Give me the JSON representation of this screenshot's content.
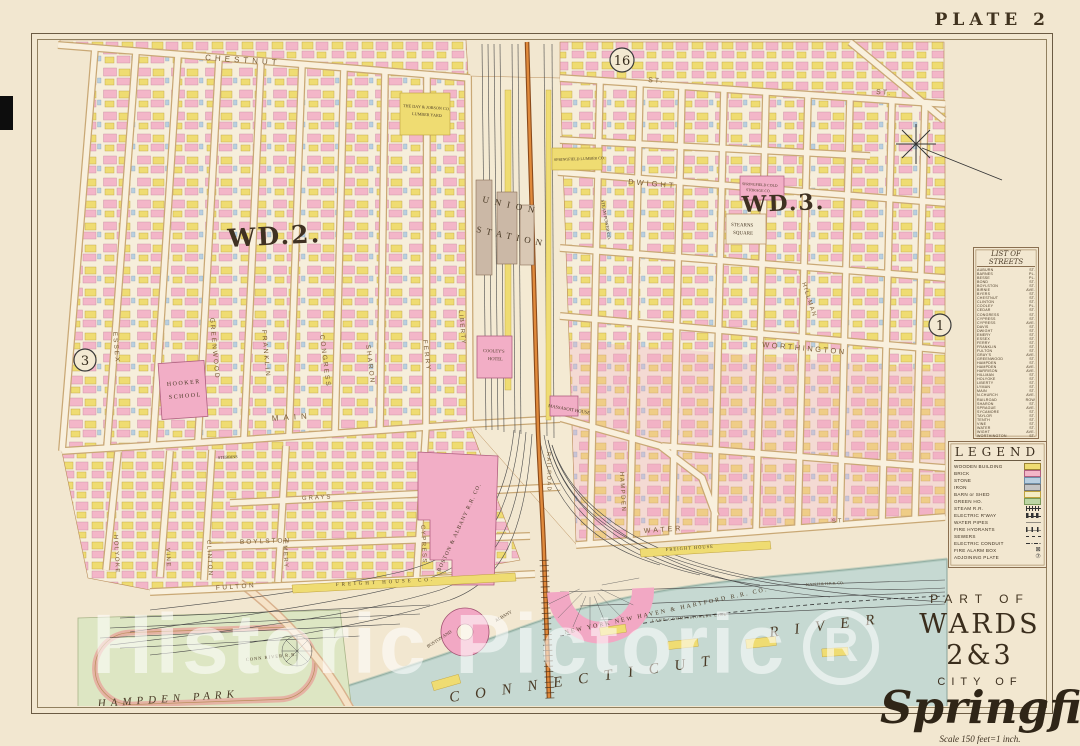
{
  "plate_label": "PLATE 2",
  "adjoining": {
    "top": "16",
    "left": "3",
    "right": "1"
  },
  "wards": {
    "wd2": "WD.2.",
    "wd3": "WD.3."
  },
  "street_labels": {
    "chestnut": "CHESTNUT",
    "st_a": "ST.",
    "st_b": "ST.",
    "dwight": "DWIGHT",
    "worthington": "WORTHINGTON",
    "main": "MAIN",
    "grays": "GRAYS",
    "boylston": "BOYLSTON",
    "fulton": "FULTON",
    "water": "WATER",
    "water_st": "ST.",
    "essex": "ESSEX",
    "greenwood": "GREENWOOD",
    "franklin": "FRANKLIN",
    "congress": "CONGRESS",
    "sharon": "SHARON",
    "ferry": "FERRY",
    "vine": "VINE",
    "clinton": "CLINTON",
    "holyoke": "HOLYOKE",
    "emery": "EMERY",
    "cypress": "CYPRESS",
    "liberty": "LIBERTY",
    "hampden": "HAMPDEN",
    "railroad": "RAILROAD",
    "hillman": "HILLMAN"
  },
  "features": {
    "union_1": "UNION",
    "union_2": "STATION",
    "massasoit": "MASSASOIT HOUSE",
    "cooleys_1": "COOLEY'S",
    "cooleys_2": "HOTEL",
    "hooker_1": "HOOKER",
    "hooker_2": "SCHOOL",
    "stearns_1": "STEARNS",
    "stearns_2": "SQUARE",
    "day_jobson_1": "THE DAY & JOBSON CO.",
    "day_jobson_2": "LUMBER YARD",
    "cold_storage_1": "SPRINGFIELD COLD",
    "cold_storage_2": "STORAGE CO.",
    "lumber": "SPRINGFIELD LUMBER CO.",
    "steam_power": "STEAM POWER CO.",
    "boston_albany_rr": "BOSTON & ALBANY R.R. CO.",
    "freight_house_1": "FREIGHT HOUSE CO.",
    "freight_house_2": "FREIGHT HOUSE",
    "nynh_rr": "NEW YORK NEW HAVEN & HARTFORD R.R. CO.",
    "nynh_small": "N.Y.N.H.& H.R.R. CO.",
    "conn_river_rr": "CONN RIVER R.R.",
    "boston_and": "BOSTON AND",
    "albany": "ALBANY",
    "land_line": "LAND COMMISSIONERS LINE",
    "stebbins": "STEBBINS",
    "hampden_park": "HAMPDEN PARK",
    "conn_river_1": "CONNECTICUT",
    "conn_river_2": "RIVER"
  },
  "streets_list": {
    "title": "LIST OF STREETS",
    "items": [
      {
        "name": "AUBURN",
        "type": "ST."
      },
      {
        "name": "BARNES",
        "type": "PL."
      },
      {
        "name": "BESSE",
        "type": "PL."
      },
      {
        "name": "BOND",
        "type": "ST."
      },
      {
        "name": "BOYLSTON",
        "type": "ST."
      },
      {
        "name": "BIRNIE",
        "type": "AVE."
      },
      {
        "name": "BYERS",
        "type": "ST."
      },
      {
        "name": "CHESTNUT",
        "type": "ST."
      },
      {
        "name": "CLINTON",
        "type": "ST."
      },
      {
        "name": "COOLEY",
        "type": "PL."
      },
      {
        "name": "CEDAR",
        "type": "ST."
      },
      {
        "name": "CONGRESS",
        "type": "ST."
      },
      {
        "name": "CYPRESS",
        "type": "ST."
      },
      {
        "name": "CYPRESS",
        "type": "AVE."
      },
      {
        "name": "DAVIS",
        "type": "ST."
      },
      {
        "name": "DWIGHT",
        "type": "ST."
      },
      {
        "name": "EMERY",
        "type": "ST."
      },
      {
        "name": "ESSEX",
        "type": "ST."
      },
      {
        "name": "FERRY",
        "type": "ST."
      },
      {
        "name": "FRANKLIN",
        "type": "ST."
      },
      {
        "name": "FULTON",
        "type": "ST."
      },
      {
        "name": "GRAY'S",
        "type": "AVE."
      },
      {
        "name": "GREENWOOD",
        "type": "ST."
      },
      {
        "name": "HAMPDEN",
        "type": "ST."
      },
      {
        "name": "HAMPDEN",
        "type": "AVE."
      },
      {
        "name": "HARRISON",
        "type": "AVE."
      },
      {
        "name": "HILLMAN",
        "type": "ST."
      },
      {
        "name": "HOLYOKE",
        "type": "ST."
      },
      {
        "name": "LIBERTY",
        "type": "ST."
      },
      {
        "name": "LYMAN",
        "type": "ST."
      },
      {
        "name": "MAIN",
        "type": "ST."
      },
      {
        "name": "N.CHURCH",
        "type": "AVE."
      },
      {
        "name": "RAILROAD",
        "type": "ROW"
      },
      {
        "name": "SHARON",
        "type": "ST."
      },
      {
        "name": "SPRAGUE",
        "type": "AVE."
      },
      {
        "name": "SYCAMORE",
        "type": "ST."
      },
      {
        "name": "TAYLOR",
        "type": "ST."
      },
      {
        "name": "TENTH",
        "type": "ST."
      },
      {
        "name": "VINE",
        "type": "ST."
      },
      {
        "name": "WATER",
        "type": "ST."
      },
      {
        "name": "WIGHT",
        "type": "AVE."
      },
      {
        "name": "WORTHINGTON",
        "type": "ST."
      }
    ]
  },
  "legend": {
    "title": "LEGEND",
    "items": [
      {
        "label": "WOODEN BUILDING",
        "swatch": "sw-wood",
        "glyph": ""
      },
      {
        "label": "BRICK",
        "swatch": "sw-brick",
        "glyph": ""
      },
      {
        "label": "STONE",
        "swatch": "sw-stone",
        "glyph": ""
      },
      {
        "label": "IRON",
        "swatch": "sw-iron",
        "glyph": ""
      },
      {
        "label": "BARN or SHED",
        "swatch": "sw-barn",
        "glyph": ""
      },
      {
        "label": "GREEN HO.",
        "swatch": "sw-green",
        "glyph": ""
      },
      {
        "label": "STEAM R.R.",
        "swatch": "sw-steam",
        "glyph": ""
      },
      {
        "label": "ELECTRIC R'WAY",
        "swatch": "sw-electric",
        "glyph": ""
      },
      {
        "label": "WATER PIPES",
        "swatch": "sw-water",
        "glyph": ""
      },
      {
        "label": "FIRE HYDRANTS",
        "swatch": "sw-hydrant",
        "glyph": ""
      },
      {
        "label": "SEWERS",
        "swatch": "sw-sewer",
        "glyph": ""
      },
      {
        "label": "ELECTRIC CONDUIT",
        "swatch": "sw-conduit",
        "glyph": ""
      },
      {
        "label": "FIRE ALARM BOX",
        "swatch": "sw-alarm",
        "glyph": "⊠"
      },
      {
        "label": "ADJOINING PLATE",
        "swatch": "sw-plate",
        "glyph": "⑦"
      }
    ]
  },
  "title_block": {
    "part_of": "PART OF",
    "wards": "WARDS 2&3",
    "city_of": "CITY OF",
    "city": "Springfield",
    "scale": "Scale 150 feet=1 inch."
  },
  "watermark": {
    "text": "Historic Pictoric",
    "mark": "R"
  },
  "colors": {
    "brick": "#f3b6c8",
    "wood": "#efdc72",
    "stone": "#b9cfe0",
    "river": "#c6d9d2",
    "park": "#dde6c3",
    "rail_orange": "#c06a22",
    "paper": "#f2e7d0"
  }
}
